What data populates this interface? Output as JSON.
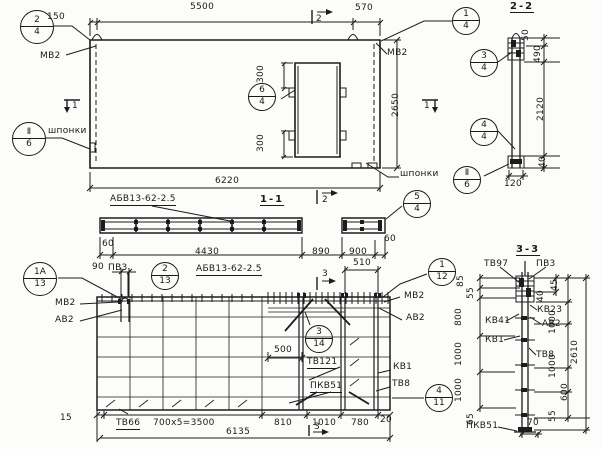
{
  "elevation": {
    "callout_2_4": {
      "top": "2",
      "bot": "4"
    },
    "callout_1_4": {
      "top": "1",
      "bot": "4"
    },
    "callout_6_4": {
      "top": "6",
      "bot": "4"
    },
    "callout_keys_left": {
      "top": "Ⅱ",
      "bot": "6"
    },
    "callout_keys_right": {
      "top": "Ⅱ",
      "bot": "6"
    },
    "labels": {
      "mv2_left": "МВ2",
      "mv2_right": "МВ2",
      "keys_left": "шпонки",
      "keys_right": "шпонки"
    },
    "markers": {
      "m1_left": "1",
      "m1_right": "1",
      "m2_top": "2"
    },
    "dims": {
      "d150": "150",
      "d5500": "5500",
      "d570": "570",
      "d300_top": "300",
      "d300_bot": "300",
      "d2650": "2650",
      "d6220": "6220"
    }
  },
  "section_1_1": {
    "title": "1-1",
    "panel_mark": "АБВ13-62-2.5",
    "marker2": "2",
    "callout_5_4": {
      "top": "5",
      "bot": "4"
    },
    "dims": {
      "d60_left": "60",
      "d4430": "4430",
      "d890": "890",
      "d900": "900",
      "d60_right": "60"
    }
  },
  "plan": {
    "panel_mark": "АБВ13-62-2.5",
    "callout_1a_13": {
      "top": "1А",
      "bot": "13"
    },
    "callout_2_13": {
      "top": "2",
      "bot": "13"
    },
    "callout_1_12": {
      "top": "1",
      "bot": "12"
    },
    "callout_3_14": {
      "top": "3",
      "bot": "14"
    },
    "callout_4_11": {
      "top": "4",
      "bot": "11"
    },
    "markers": {
      "m3_top": "3",
      "m3_bot": "3"
    },
    "labels": {
      "pv3": "ПВ3",
      "mv2_left": "МВ2",
      "av2_left": "АВ2",
      "mv2_right": "МВ2",
      "av2_right": "АВ2",
      "tv121": "ТВ121",
      "kv1": "КВ1",
      "tv8": "ТВ8",
      "pkv51": "ПКВ51",
      "tv66": "ТВ66"
    },
    "dims": {
      "d90": "90",
      "d510": "510",
      "d500": "500",
      "d15": "15",
      "d700x5": "700х5=3500",
      "d810": "810",
      "d1010": "1010",
      "d780": "780",
      "d20": "20",
      "d6135": "6135"
    }
  },
  "section_2_2": {
    "title": "2-2",
    "callout_3_4": {
      "top": "3",
      "bot": "4"
    },
    "callout_4_4": {
      "top": "4",
      "bot": "4"
    },
    "dims": {
      "d50": "50",
      "d490": "490",
      "d2120": "2120",
      "d40": "40",
      "d120": "120"
    }
  },
  "section_3_3": {
    "title": "3-3",
    "labels": {
      "tv97": "ТВ97",
      "pv3": "ПВ3",
      "kv23": "КВ23",
      "av2": "АВ2",
      "kv41": "КВ41",
      "kv1": "КВ1",
      "tv8": "ТВ8",
      "pkv51": "ПКВ51"
    },
    "dims_left": {
      "d85": "85",
      "d55": "55",
      "d800": "800",
      "d1000a": "1000",
      "d1000b": "1000",
      "d65": "65"
    },
    "dims_right": {
      "d45": "45",
      "d40": "40",
      "d1000c": "1000",
      "d1000d": "1000",
      "d600": "600",
      "d55": "55",
      "d2610": "2610",
      "d70": "70"
    }
  }
}
